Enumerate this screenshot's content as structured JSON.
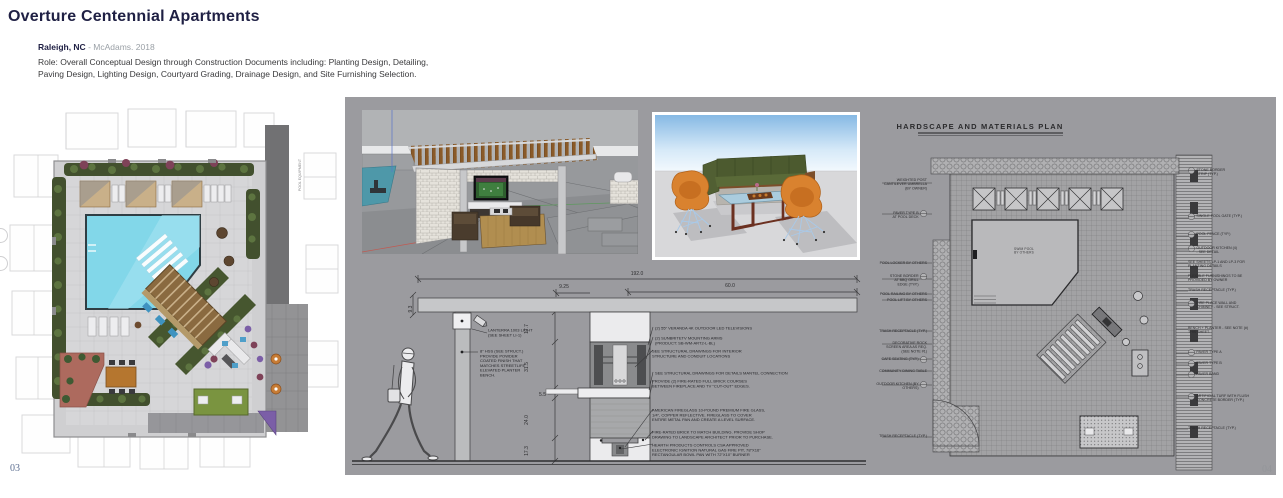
{
  "header": {
    "title": "Overture Centennial Apartments",
    "location": "Raleigh, NC",
    "firm_year": " - McAdams. 2018",
    "role": "Role: Overall Conceptual Design through Construction Documents including: Planting Design, Detailing,\nPaving Design, Lighting Design, Courtyard Grading, Drainage Design, and Site Furnishing Selection."
  },
  "pages": {
    "left_number": "03",
    "right_number": "04"
  },
  "site_plan": {
    "pool_equipment_label": "POOL EQUIPMENT"
  },
  "elevation": {
    "dim_overall": "192.0",
    "dim_tv_offset": "9.25",
    "dim_tv_width": "60.0",
    "dim_beam_height": "9.3",
    "dim_v": [
      "17.7",
      "31.5",
      "5.5",
      "24.0",
      "17.3"
    ],
    "left_notes": [
      "LANTERRA 1003 LIGHT\n(SEE SHEET LI-1)",
      "8\" HSS (SEE STRUCT.)\nPROVIDE POWDER\nCOATED FINISH THAT\nMATCHES STREETLIFE\nELEVATED PLANTER\nBENCH."
    ],
    "right_notes": [
      "(2) 55\" VERANDA 4K OUTDOOR LED TELEVISIONS",
      "(2) SUNBRITETV MOUNTING ARMS\n(PRODUCT: SB-WM-ART2-L-BL)",
      "SEE STRUCTURAL DRAWINGS FOR INTERIOR\nSTRUCTURE AND CONDUIT LOCATIONS",
      "SEE STRUCTURAL DRAWINGS FOR DETAILS MANTEL CONNECTION",
      "PROVIDE (2) FIRE-RATED FULL BRICK COURSES\nBETWEEN FIREPLACE AND TV \"CUT-OUT\" EDGES.",
      "AMERICAN FIREGLASS 10-POUND PREMIUM FIRE GLASS,\n1/4\", COPPER REFLECTIVE. FIREGLASS TO COVER\nENTIRE METAL PAN AND CREATE A LEVEL SURFACE.",
      "FIRE-RATED BRICK TO MATCH BUILDING. PROVIDE SHOP\nDRAWING TO LANDSCAPE ARCHITECT PRIOR TO PURCHASE.",
      "HEARTH PRODUCTS CONTROLS CSA APPROVED\nELECTRONIC IGNITION NATURAL GAS FIRE PIT, 78\"X16\"\nRECTANGULAR BOWL PAN WITH 72\"X10\" BURNER"
    ]
  },
  "hardscape": {
    "title": "HARDSCAPE AND MATERIALS PLAN",
    "pool_label": "SWIM POOL\nBY OTHERS",
    "left_keynotes": [
      {
        "label": "WEIGHTED POST\nCANTILEVER UMBRELLA\n(BY OWNER)",
        "sym": false
      },
      {
        "label": "PAVER TYPE B\nAT POOL DECK",
        "sym": true
      },
      {
        "label": "POOL LOCKER BY OTHERS",
        "sym": false
      },
      {
        "label": "STONE BORDER\nAT BBQ GRILL\nEDGE (TYP.)",
        "sym": true
      },
      {
        "label": "POOL RAILING BY OTHERS",
        "sym": false
      },
      {
        "label": "POOL LIFT BY OTHERS",
        "sym": false
      },
      {
        "label": "TRASH RECEPTACLE (TYP.)",
        "sym": false
      },
      {
        "label": "DECORATIVE ROCK\nSCREEN AREA AS REQ.\n(SEE NOTE #1)",
        "sym": false
      },
      {
        "label": "CAFE SEATING (TYP.)",
        "sym": true
      },
      {
        "label": "COMMUNITY DINING TABLE",
        "sym": false
      },
      {
        "label": "OUTDOOR KITCHEN (BY\nOTHERS)",
        "sym": true
      },
      {
        "label": "TRASH RECEPTACLE (TYP.)",
        "sym": false
      }
    ],
    "right_keynotes": [
      {
        "label": "STONE BORDER\nSTRIP (TYP.)",
        "sym": true
      },
      {
        "label": "SINGLE POOL GATE (TYP.)",
        "sym": true
      },
      {
        "label": "POOL FENCE (TYP.)",
        "sym": true
      },
      {
        "label": "OUTDOOR KITCHEN (4)\n- SEE DETAIL",
        "sym": true
      },
      {
        "label": "SEE SHEETS LP-1 AND LP-3 FOR\nPLANTING DETAILS",
        "sym": false
      },
      {
        "label": "FLEXIBLE FURNISHINGS TO BE\nPROVIDED BY OWNER",
        "sym": false
      },
      {
        "label": "TRASH RECEPTACLE (TYP.)",
        "sym": false
      },
      {
        "label": "FIRE PLACE WALL AND\nCHIMNEY - SEE STRUCT.",
        "sym": true
      },
      {
        "label": "BENCH + PLANTER - SEE NOTE (#)\nTHIS SHEET.",
        "sym": false
      },
      {
        "label": "PAVER TYPE A",
        "sym": true
      },
      {
        "label": "PAVER TYPE B",
        "sym": true
      },
      {
        "label": "PAVER BAND",
        "sym": true
      },
      {
        "label": "ARTIFICIAL TURF WITH FLUSH\nCONCRETE BORDER (TYP.)",
        "sym": true
      },
      {
        "label": "TRASH RECEPTACLE (TYP.)",
        "sym": false
      }
    ]
  }
}
